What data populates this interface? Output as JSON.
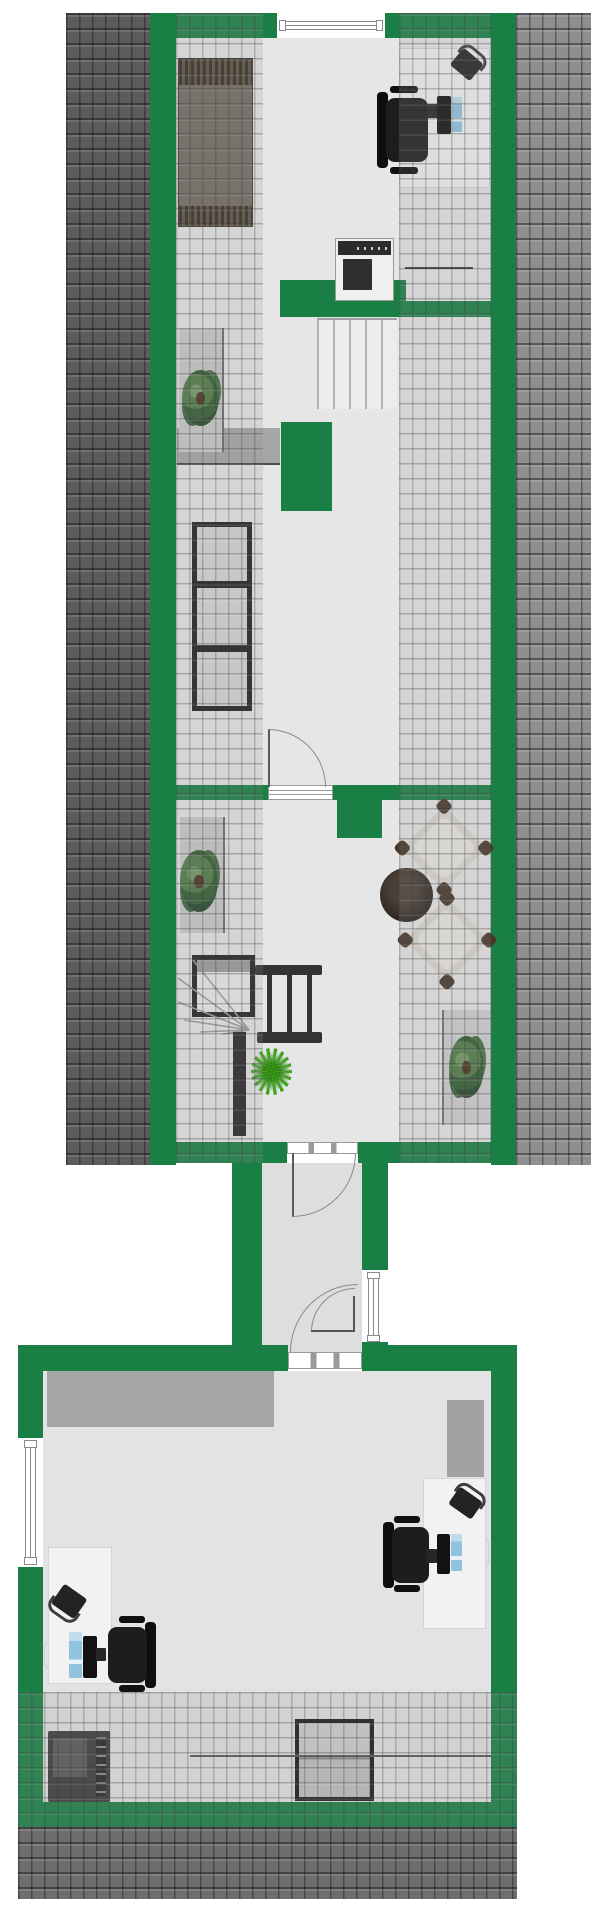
{
  "title": "Attic and ground-floor office floor plan",
  "colors": {
    "wall_green": "#1a7f44",
    "roof_dark": "#5c5c5c",
    "roof_light": "#8f8f8f",
    "roof_bottom": "#6e6e6e",
    "floor_gray": "#e6e6e6",
    "corridor_gray": "#dedede",
    "ceiling_gray": "#a6a6a6",
    "desk_white": "#f2f2f2",
    "bed_brown": "#746b62",
    "bed_band": "#4e4337",
    "shelf_fill": "#d6d6d6",
    "frame_black": "#1f1f1f",
    "paper_blue": "#8fc3e0",
    "printer_body": "#efefef",
    "armchair_beige": "#dbd8d1",
    "armchair_pad": "#46362a",
    "palm_green": "#3fa321"
  },
  "floorplan": {
    "upper_building": {
      "rooms": [
        {
          "name": "attic-office-bedroom",
          "furniture": [
            "bed",
            "desk",
            "office-chair",
            "monitor",
            "keyboard",
            "document",
            "telephone",
            "printer-copier",
            "cabinet"
          ]
        },
        {
          "name": "attic-storage-room",
          "furniture": [
            "shelving-unit-3-compartments",
            "sideboard",
            "potted-plant"
          ],
          "stairs": "straight-staircase"
        },
        {
          "name": "attic-lounge",
          "furniture": [
            "armchair",
            "armchair",
            "round-side-table",
            "sideboard",
            "sideboard",
            "potted-plant",
            "potted-plant",
            "palm-plant"
          ],
          "stairs": "winder-staircase-with-railing-and-landing"
        }
      ],
      "windows": [
        "top-exterior-window"
      ],
      "doors": [
        "storage-to-lounge-door",
        "lounge-to-corridor-door"
      ]
    },
    "corridor": {
      "windows": [
        "right-wall-window"
      ],
      "doors": [
        "door-from-upper-building",
        "door-to-lower-room"
      ]
    },
    "lower_building": {
      "rooms": [
        {
          "name": "ground-office",
          "furniture": [
            "desk",
            "office-chair",
            "monitor",
            "keyboard",
            "document",
            "telephone",
            "desk",
            "office-chair",
            "monitor",
            "keyboard",
            "document",
            "telephone",
            "printer-copier",
            "square-table"
          ]
        }
      ],
      "windows": [
        "left-wall-window"
      ],
      "doors": [
        "door-from-corridor"
      ]
    }
  }
}
